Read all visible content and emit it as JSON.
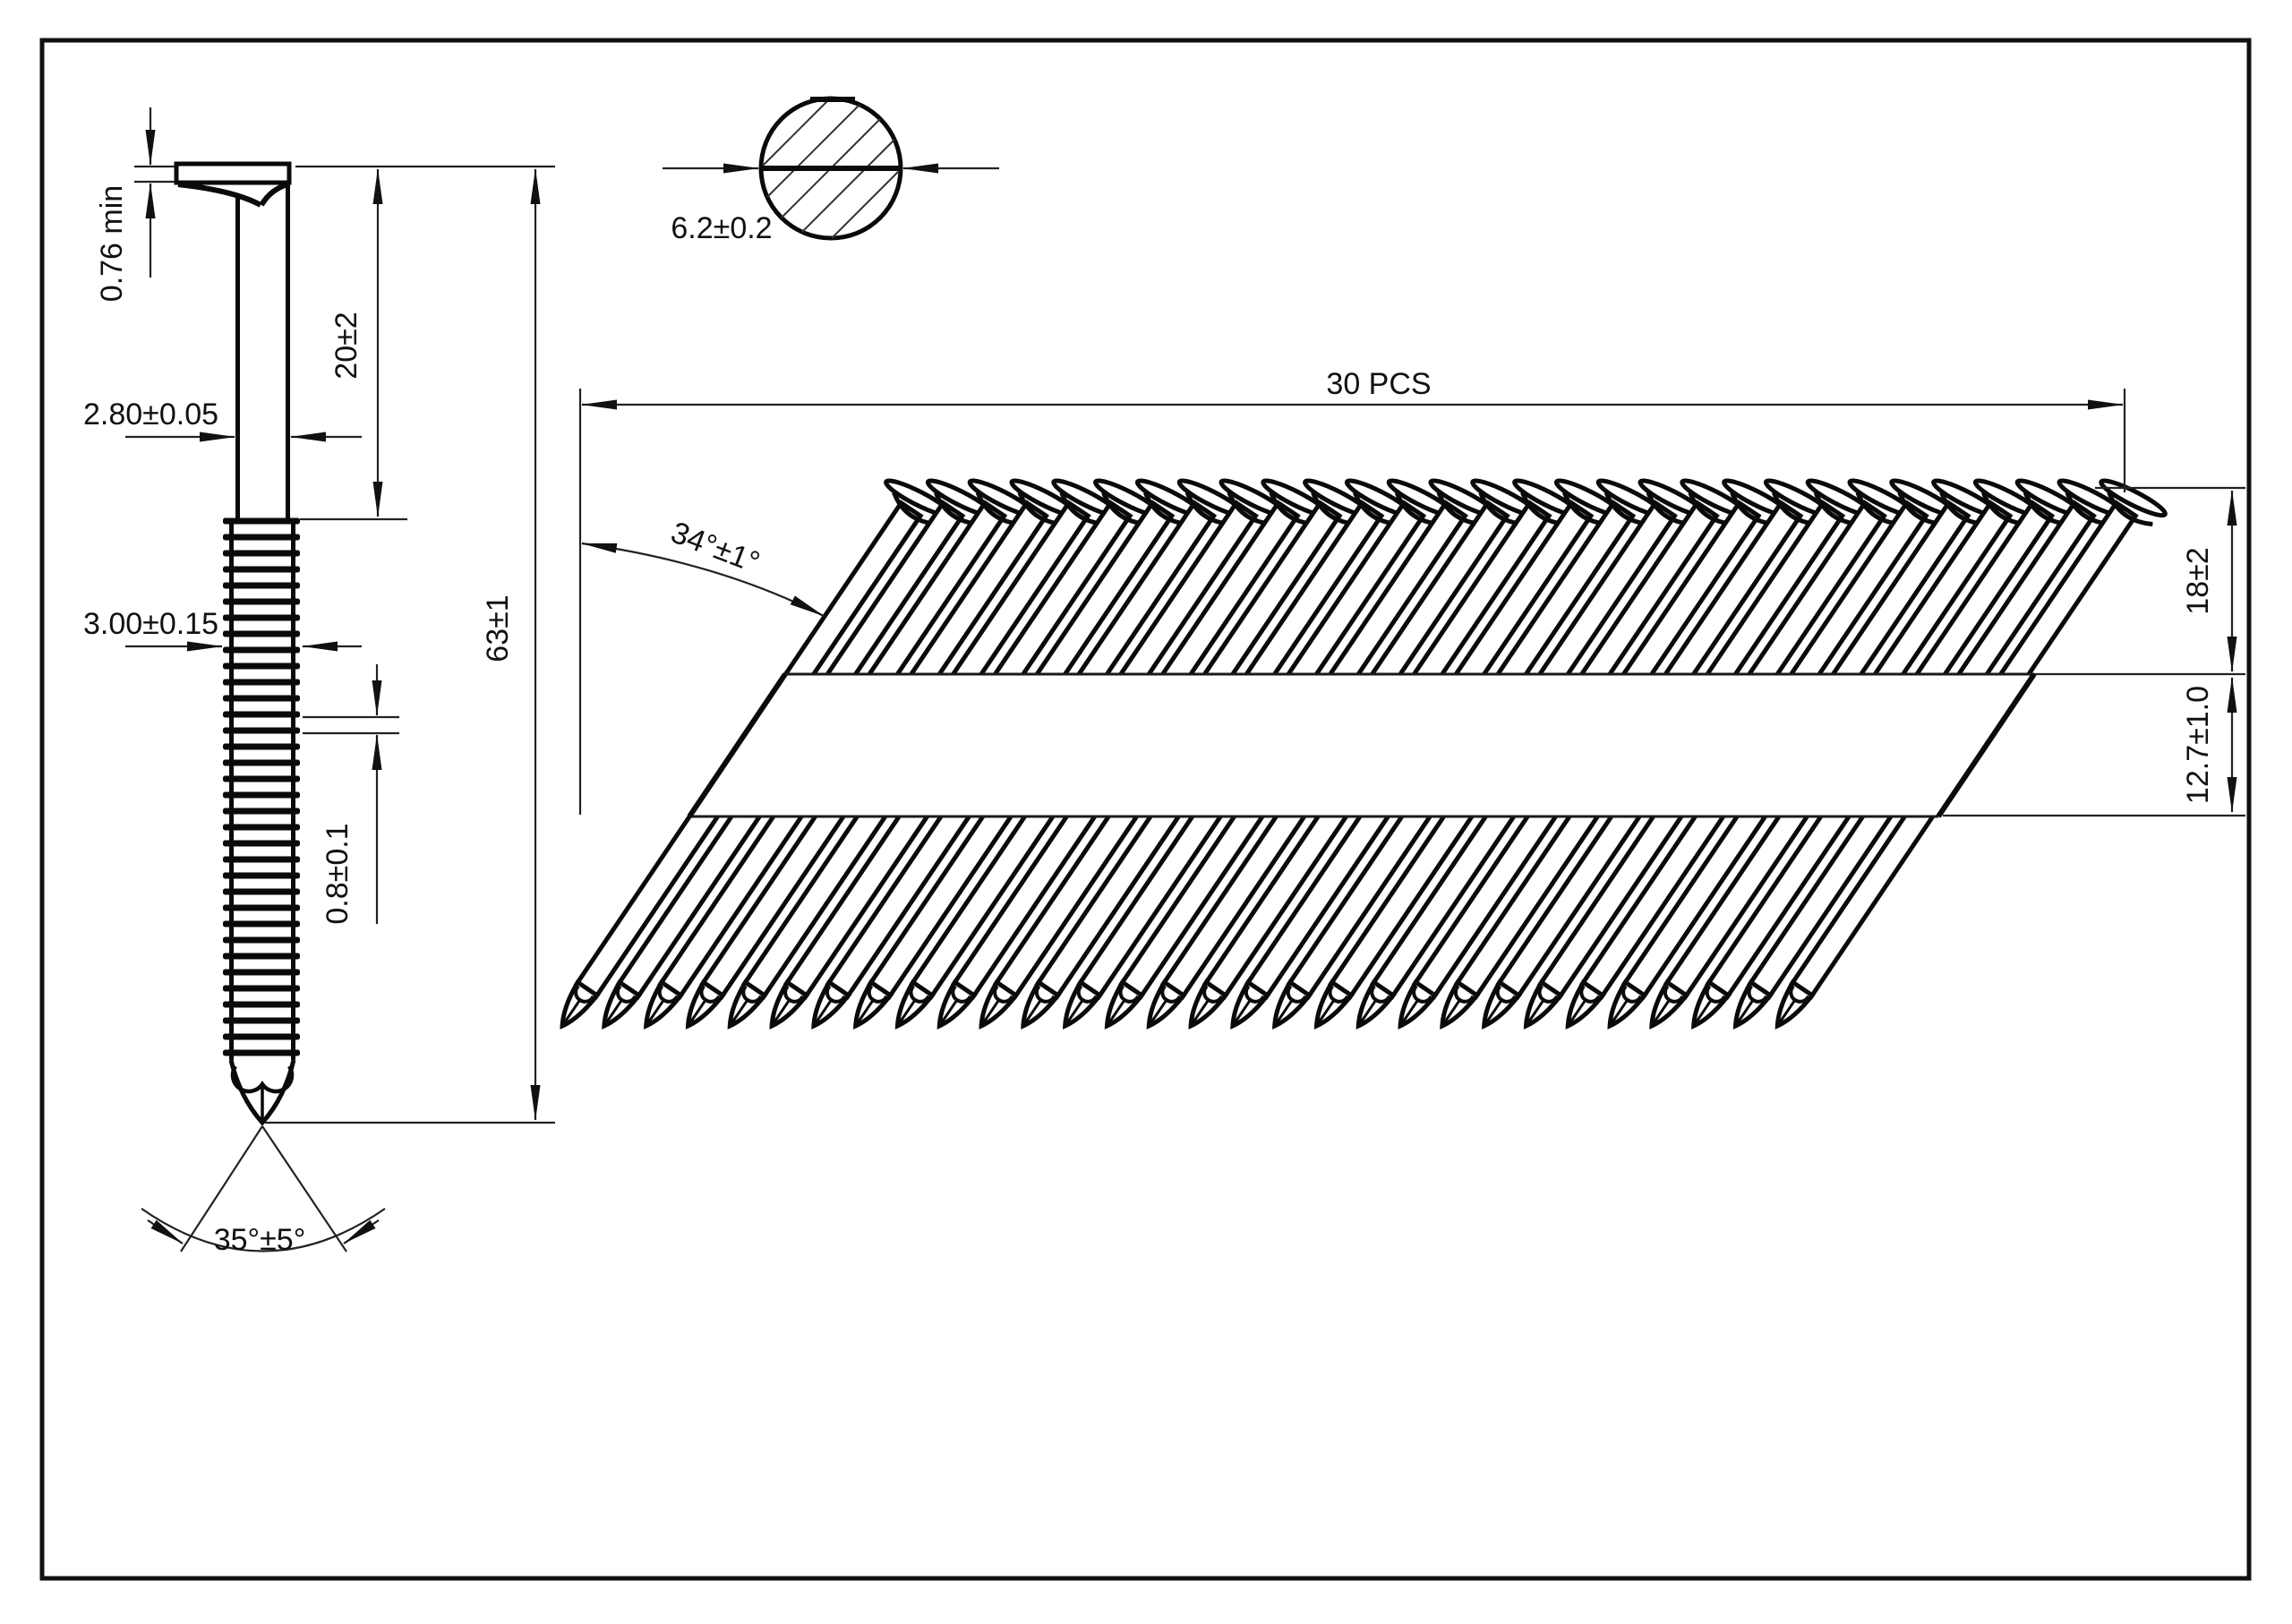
{
  "sheet": {
    "type_label": "technical drawing — collated framing nail strip",
    "colors": {
      "ink": "#111111",
      "paper": "#ffffff"
    }
  },
  "side_view": {
    "head_thickness_label": "0.76 min",
    "smooth_length_label": "20±2",
    "shank_dia_label": "2.80±0.05",
    "ring_dia_label": "3.00±0.15",
    "ring_pitch_label": "0.8±0.1",
    "total_length_label": "63±1",
    "point_angle_label": "35°±5°"
  },
  "section_view": {
    "head_dia_label": "6.2±0.2"
  },
  "strip_view": {
    "count": 30,
    "count_label": "30 PCS",
    "angle_label": "34°±1°",
    "head_offset_label": "18±2",
    "tape_width_label": "12.7±1.0"
  }
}
